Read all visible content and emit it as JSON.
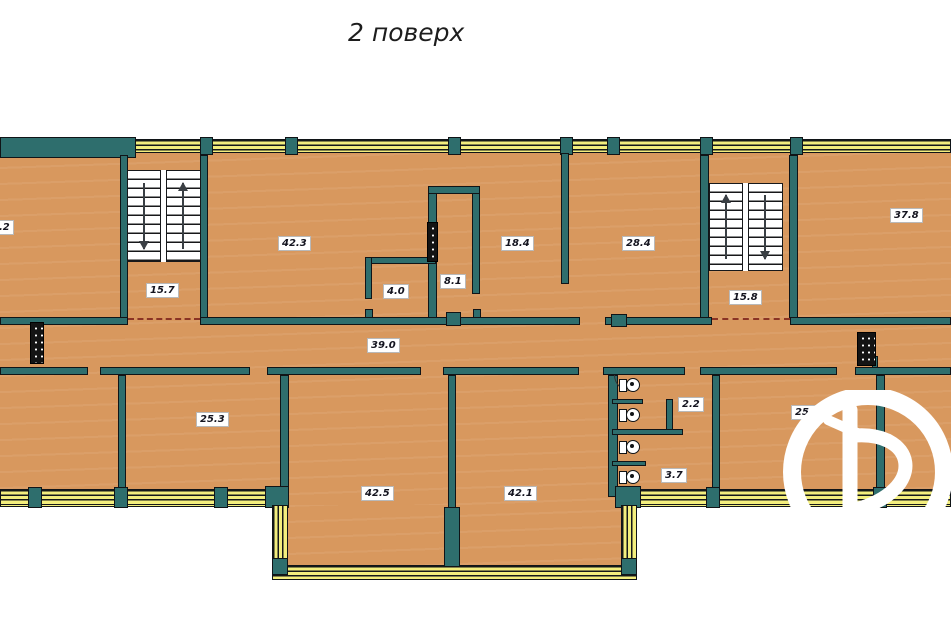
{
  "title": "2 поверх",
  "rooms": [
    {
      "name": "room-left-clipped",
      "area": "1.2"
    },
    {
      "name": "stairwell-left",
      "area": "15.7"
    },
    {
      "name": "room-42-3",
      "area": "42.3"
    },
    {
      "name": "lobby-4-0",
      "area": "4.0"
    },
    {
      "name": "room-8-1",
      "area": "8.1"
    },
    {
      "name": "room-18-4",
      "area": "18.4"
    },
    {
      "name": "room-28-4",
      "area": "28.4"
    },
    {
      "name": "stairwell-right",
      "area": "15.8"
    },
    {
      "name": "room-37-8",
      "area": "37.8"
    },
    {
      "name": "corridor",
      "area": "39.0"
    },
    {
      "name": "room-25-3",
      "area": "25.3"
    },
    {
      "name": "wc-stall",
      "area": "2.2"
    },
    {
      "name": "wc-room",
      "area": "3.7"
    },
    {
      "name": "room-25-2",
      "area": "25.2"
    },
    {
      "name": "room-42-5",
      "area": "42.5"
    },
    {
      "name": "room-42-1",
      "area": "42.1"
    }
  ],
  "fixtures": {
    "toilets": 4,
    "ventilation_shafts": 3,
    "stairwells": 2
  },
  "colors": {
    "floor": "#d8985e",
    "walls": "#2e6e6d",
    "windows": "#f3ee7d",
    "stairs": "#ffffff",
    "watermark": "#ffffff"
  }
}
